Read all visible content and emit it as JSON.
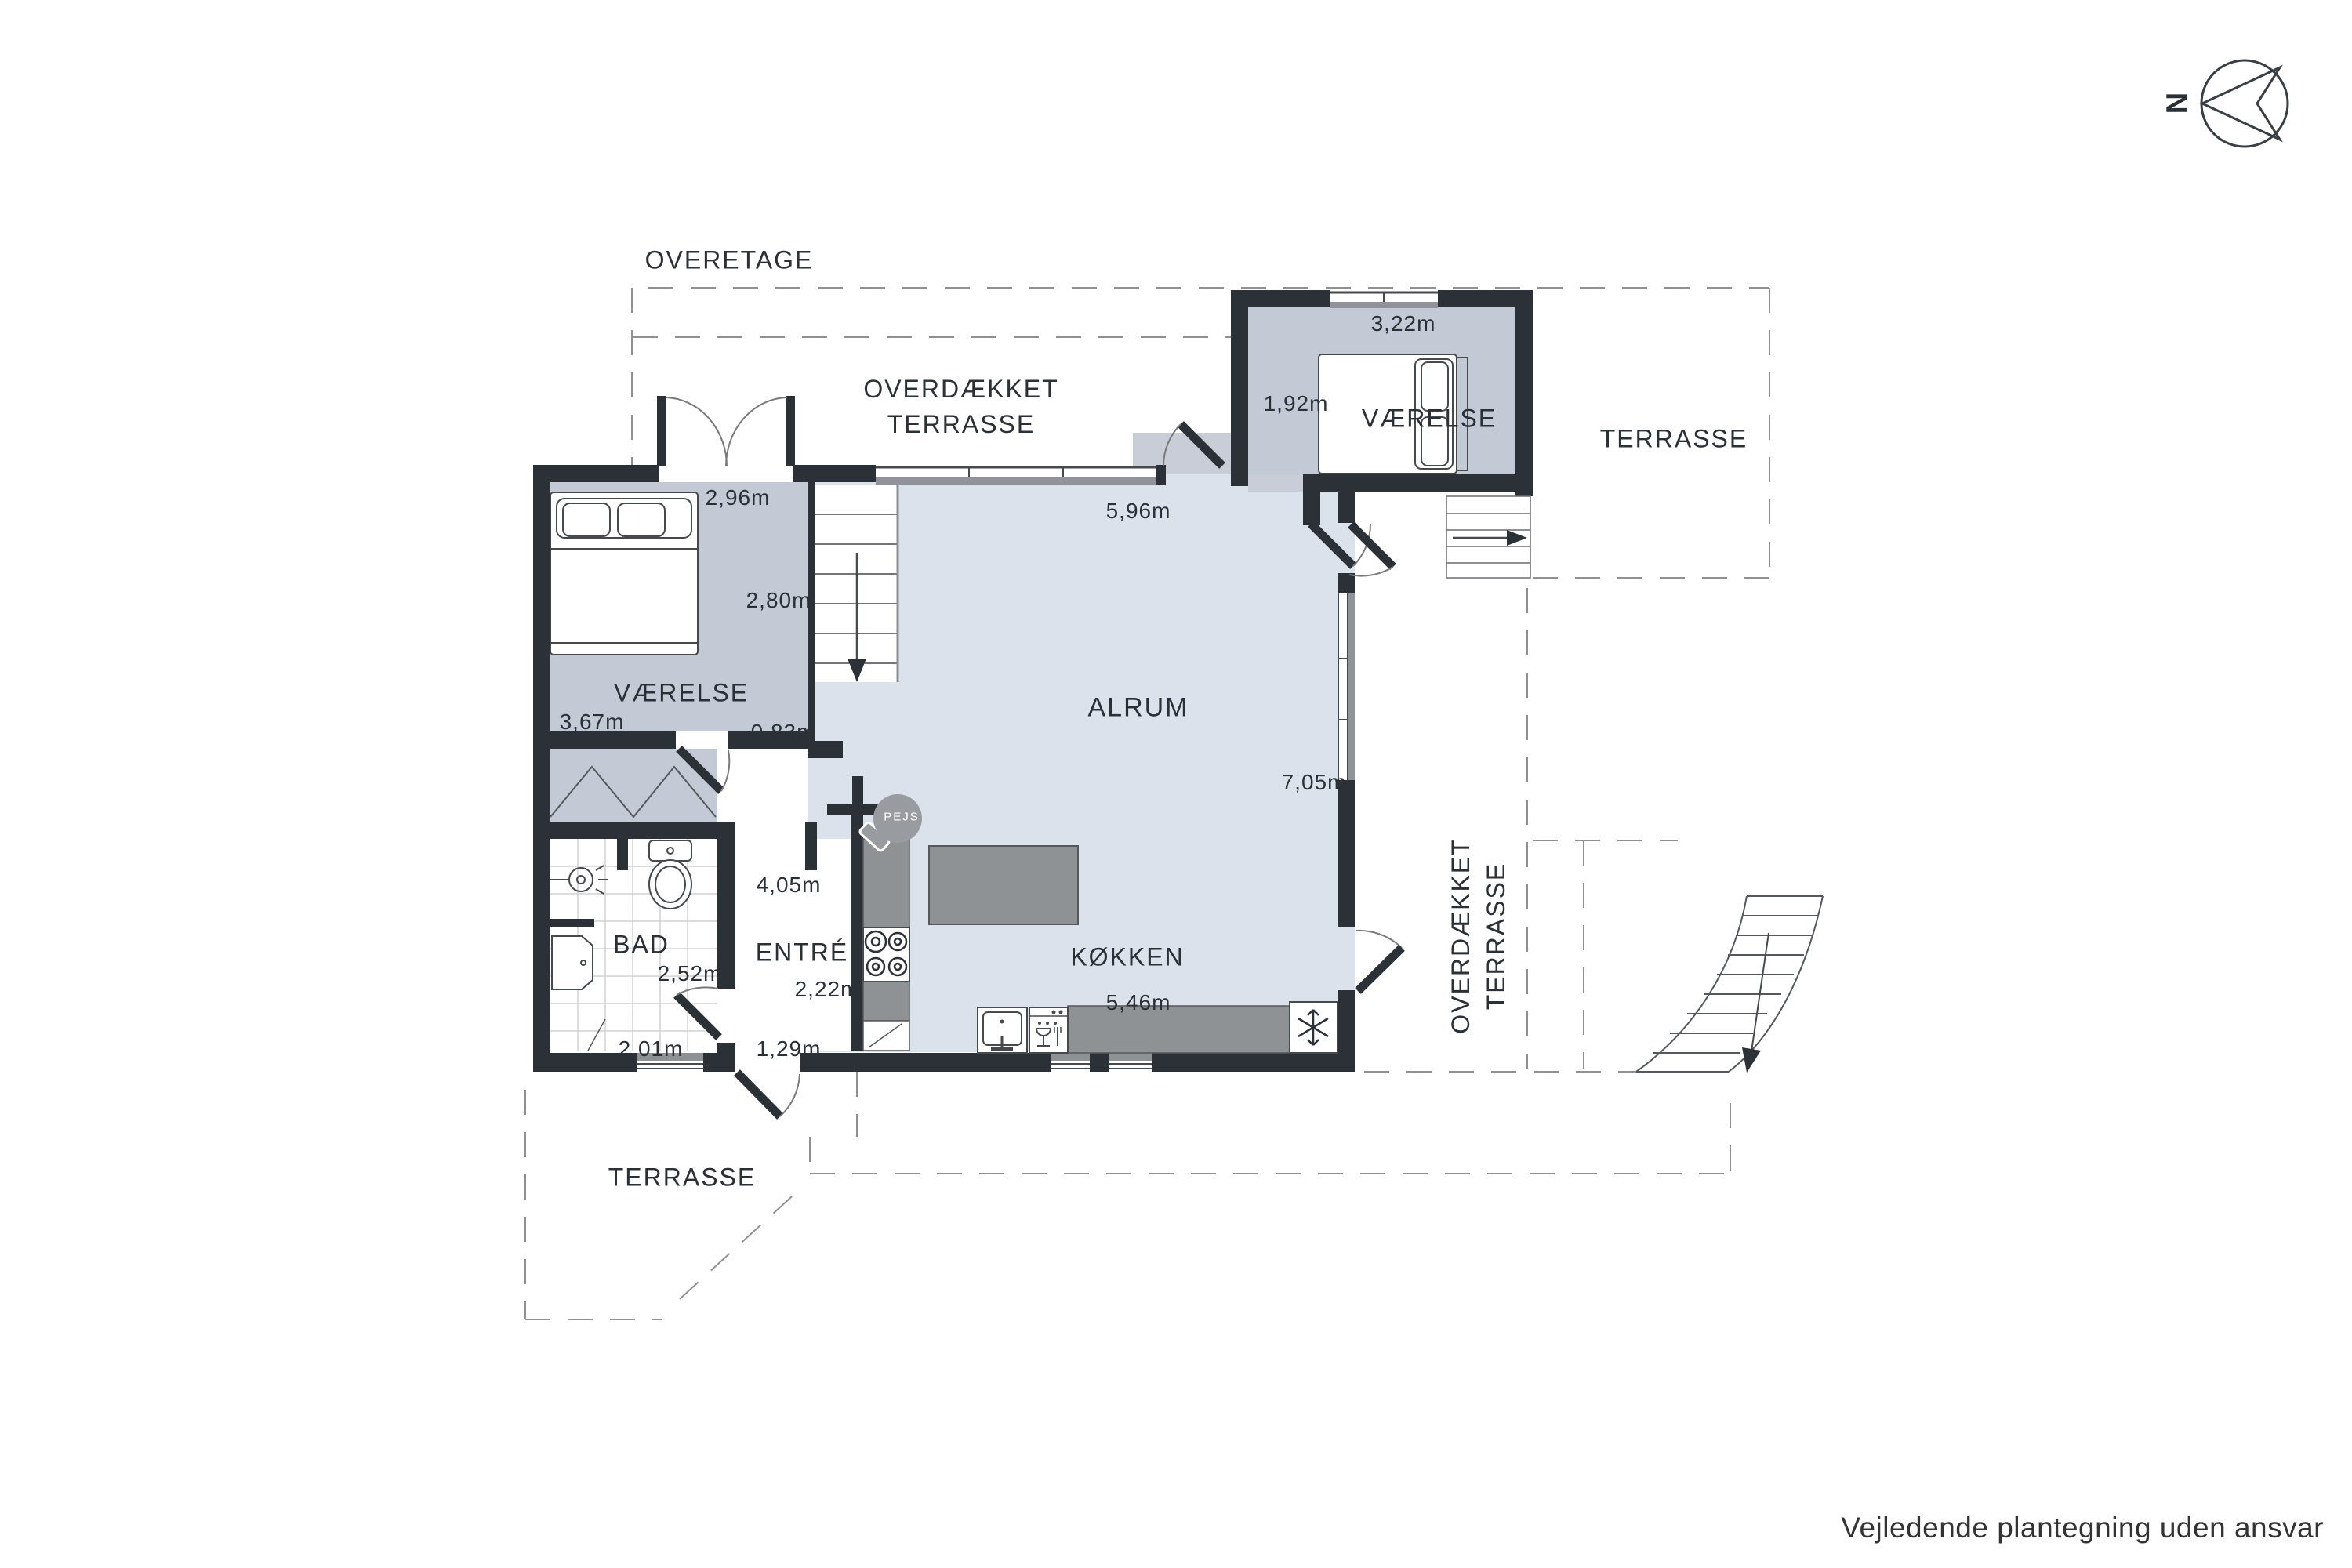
{
  "compass": {
    "label": "N"
  },
  "labels": {
    "overetage": "OVERETAGE",
    "covered_terrace_top": [
      "OVERDÆKKET",
      "TERRASSE"
    ],
    "covered_terrace_right": [
      "OVERDÆKKET",
      "TERRASSE"
    ]
  },
  "rooms": {
    "vaerelse_annex": "VÆRELSE",
    "terrasse_top": "TERRASSE",
    "vaerelse_left": "VÆRELSE",
    "alrum": "ALRUM",
    "bad": "BAD",
    "entre": "ENTRÉ",
    "koekken": "KØKKEN",
    "terrasse_bottom": "TERRASSE"
  },
  "dims": {
    "annex_width": "3,22m",
    "annex_depth": "1,92m",
    "vaerelse_left_width": "2,96m",
    "vaerelse_left_depth": "2,80m",
    "vaerelse_left_height": "3,67m",
    "hall_width": "0,83m",
    "alrum_width": "5,96m",
    "alrum_depth": "7,05m",
    "bad_width": "2,52m",
    "bad_width_lower": "2,01m",
    "entre_depth": "4,05m",
    "entre_width": "2,22m",
    "entry_door_width": "1,29m",
    "koekken_width": "5,46m"
  },
  "fireplace": {
    "label": "PEJS"
  },
  "footer": {
    "disclaimer": "Vejledende plantegning uden ansvar"
  },
  "colors": {
    "wall": "#2c3137",
    "floor_light": "#dce2ec",
    "floor_gray": "#c3c9d5",
    "counter": "#8f9295",
    "dash": "#909090"
  }
}
